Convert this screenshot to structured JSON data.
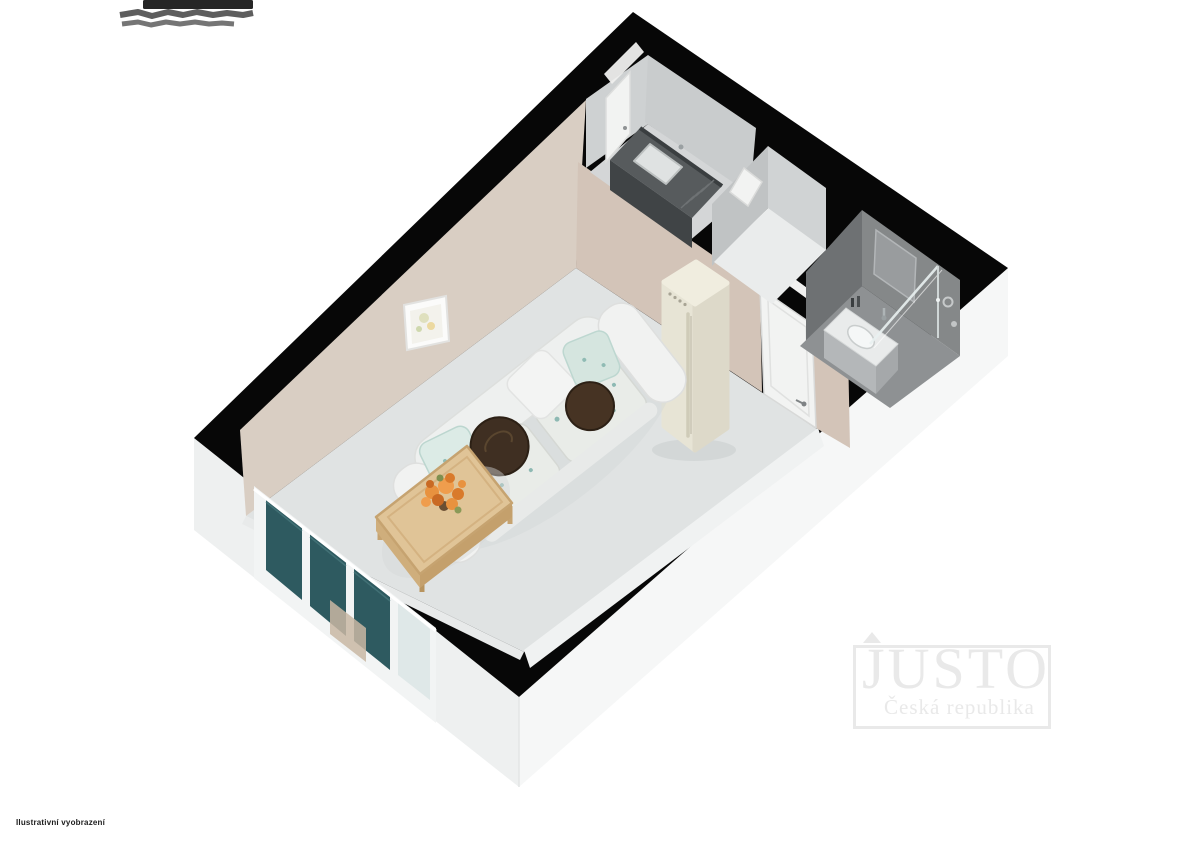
{
  "canvas": {
    "width": 1200,
    "height": 849
  },
  "branding": {
    "watermark_title": "JUSTO",
    "watermark_subtitle": "Česká republika"
  },
  "footer": {
    "disclaimer": "Ilustrativní vyobrazení"
  },
  "scene": {
    "type": "3d-floor-plan",
    "description": "Axonometric 3D floor plan of a small studio apartment",
    "rooms": [
      {
        "name": "living-room",
        "furniture": [
          "sofa",
          "coffee-table",
          "flower-bouquet",
          "refrigerator",
          "wall-picture",
          "window-wall",
          "interior-door"
        ]
      },
      {
        "name": "kitchen-nook",
        "furniture": [
          "kitchen-counter",
          "sink",
          "entry-door"
        ]
      },
      {
        "name": "hallway-closet",
        "furniture": [
          "closet-door"
        ]
      },
      {
        "name": "bathroom",
        "furniture": [
          "vanity-sink",
          "mirror",
          "shower-screen",
          "towel-ring"
        ]
      }
    ]
  },
  "colors": {
    "page_bg": "#ffffff",
    "wall_top": "#070707",
    "wall_beige": "#d9cec3",
    "wall_beige_dark": "#d3c4b8",
    "wall_gray": "#ced1d2",
    "wall_gray_dark": "#c0c3c4",
    "floor_living": "#e0e3e3",
    "floor_kitchen": "#d4d6d7",
    "floor_closet": "#eaecec",
    "bath_wall": "#6e7173",
    "bath_wall_light": "#858889",
    "bath_floor": "#8e9193",
    "ext_face": "#eef0f0",
    "ext_face_light": "#f6f7f7",
    "window_glass": "#2e5a60",
    "curtain": "#c9b7a3",
    "door_white": "#f2f3f2",
    "fridge_body": "#e7e4d5",
    "fridge_side": "#ddd9c9",
    "fridge_top": "#f0eddf",
    "sofa_body": "#eef0ef",
    "cushion": "#e9ece8",
    "cushion_teal": "#7fb1aa",
    "pillow_brown": "#3f2f22",
    "wood": "#e0c497",
    "wood_dark": "#c6a370",
    "flower_orange": "#e8923f",
    "counter_top": "#575b5d",
    "counter_front": "#404446",
    "watermark": "#e9e9e9",
    "footer_text": "#1c1c1c",
    "redaction_dark": "#262626",
    "redaction_scribble": "#555555"
  }
}
